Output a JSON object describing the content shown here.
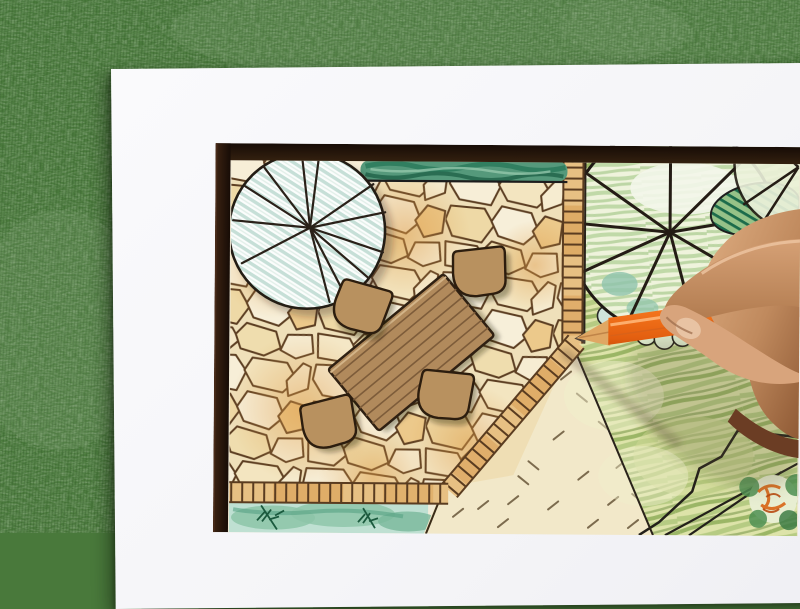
{
  "scene": {
    "type": "photograph",
    "description": "Top-down photo of a right hand drawing a garden landscape plan with an orange colored pencil; the white plan sheet lies on green artificial grass.",
    "background_label": "artificial grass lawn",
    "paper_label": "white drawing sheet"
  },
  "plan": {
    "border_label": "dark frame border of plan",
    "elements": {
      "patio": "irregular flagstone patio, cream and orange stones",
      "shade_tree": "round tree symbol with radiating branches and blue-green hatching",
      "dining_table": "rectangular wooden table symbol with plank lines",
      "chair": "rounded patio chair symbol",
      "chairs_count": 4,
      "hedge": "green hedge strip along top edge",
      "tile_edge": "small rectangular paver edging strip",
      "lawn": "scribbled green lawn",
      "garden_tree": "large round tree symbol over cloud-outline shrubs",
      "dark_bush": "dark green hatched bush",
      "gravel_court": "sand-colored court with dash marks",
      "planting_bed": "blue-green planting bed with fern sketch",
      "corner_bed": "angular corner bed with orange-foliage tree"
    }
  },
  "hand": {
    "label": "right hand gripping pencil between thumb and index finger"
  },
  "pencil": {
    "label": "orange colored pencil, sharpened tip",
    "color_name": "orange"
  },
  "palette": {
    "grass": "#49793b",
    "paper": "#f8f8fa",
    "frame": "#20120a",
    "stone_cream": "#f6ecd2",
    "stone_orange": "#e8b36e",
    "stone_line": "#5c3e22",
    "wood": "#b18a5c",
    "hedge": "#4f9678",
    "lawn": "#dde3a9",
    "lawn_streak": "#8fae5b",
    "tree_hatch": "#c6dfd7",
    "pencil_orange": "#f0741c",
    "skin": "#c99267",
    "sand": "#f2e8c9"
  }
}
